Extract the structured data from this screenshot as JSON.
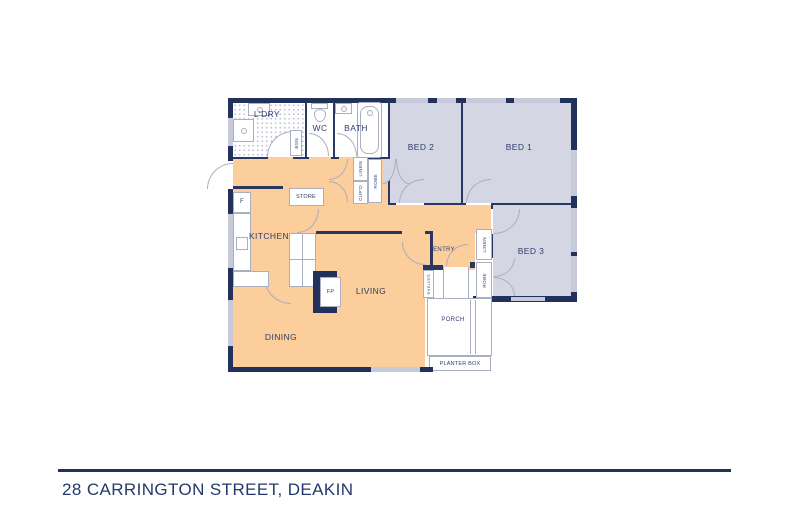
{
  "plan": {
    "rooms": {
      "ldry": "L'DRY",
      "wc": "WC",
      "bath": "BATH",
      "bed2": "BED 2",
      "bed1": "BED 1",
      "bed3": "BED 3",
      "kitchen": "KITCHEN",
      "store": "STORE",
      "living": "LIVING",
      "dining": "DINING",
      "entry": "ENTRY",
      "porch": "PORCH",
      "planter": "PLANTER BOX",
      "fridge": "F",
      "fireplace": "FP"
    },
    "closets": {
      "bsn": "BSN",
      "linen_hall": "LINEN",
      "cupd": "CUP'D",
      "robe_bed2": "ROBE",
      "linen_bed3": "LINEN",
      "robe_bed3": "ROBE",
      "shelves": "SHELVES"
    },
    "colors": {
      "walls": "#22305c",
      "bedroom_fill": "#d5d6e3",
      "living_fill": "#fbce9b",
      "window_glass": "#c6cad9"
    }
  },
  "footer": {
    "address": "28 CARRINGTON STREET, DEAKIN"
  }
}
